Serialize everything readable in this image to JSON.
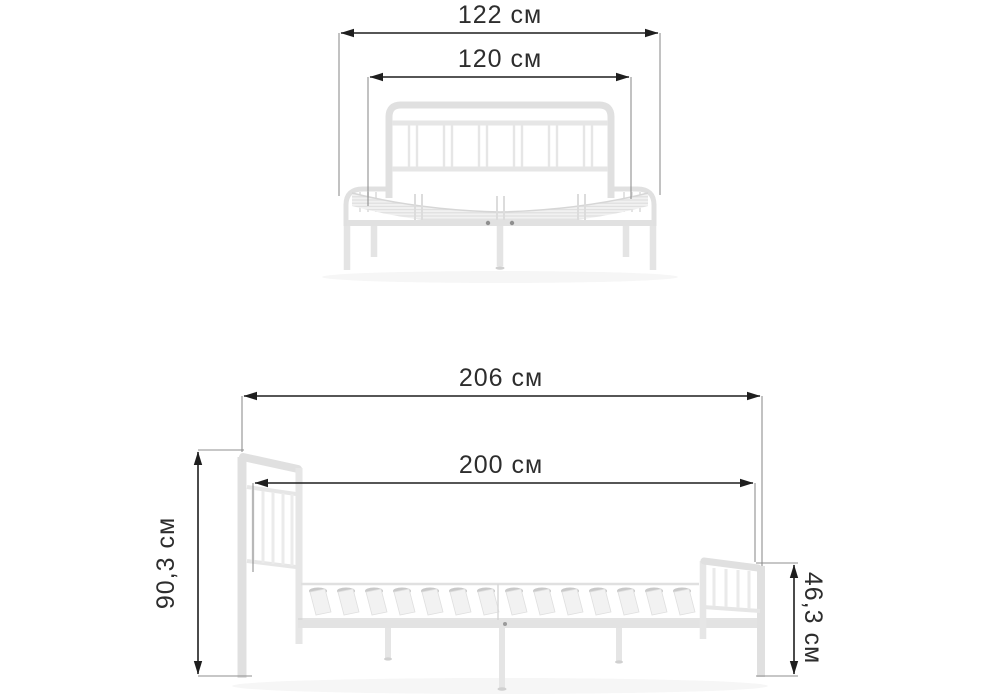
{
  "diagram": {
    "type": "product-dimension-drawing",
    "subject": "metal-bed-frame",
    "unit": "см",
    "colors": {
      "background": "#ffffff",
      "dimension_line": "#1e1e1e",
      "extension_line": "#8f8f8f",
      "label_text": "#2d2d2d",
      "product_outline": "#e0e0e0",
      "slat_hatch": "#dcdcdc",
      "shadow": "#f6f6f6"
    },
    "views": {
      "front_view": {
        "dimensions": {
          "overall_width": {
            "value": "122",
            "unit": "см",
            "label": "122 см"
          },
          "inner_width": {
            "value": "120",
            "unit": "см",
            "label": "120 см"
          }
        }
      },
      "side_view": {
        "dimensions": {
          "overall_length": {
            "value": "206",
            "unit": "см",
            "label": "206 см"
          },
          "inner_length": {
            "value": "200",
            "unit": "см",
            "label": "200 см"
          },
          "headboard_height": {
            "value": "90,3",
            "unit": "см",
            "label": "90,3 см"
          },
          "footboard_height": {
            "value": "46,3",
            "unit": "см",
            "label": "46,3 см"
          }
        }
      }
    }
  }
}
